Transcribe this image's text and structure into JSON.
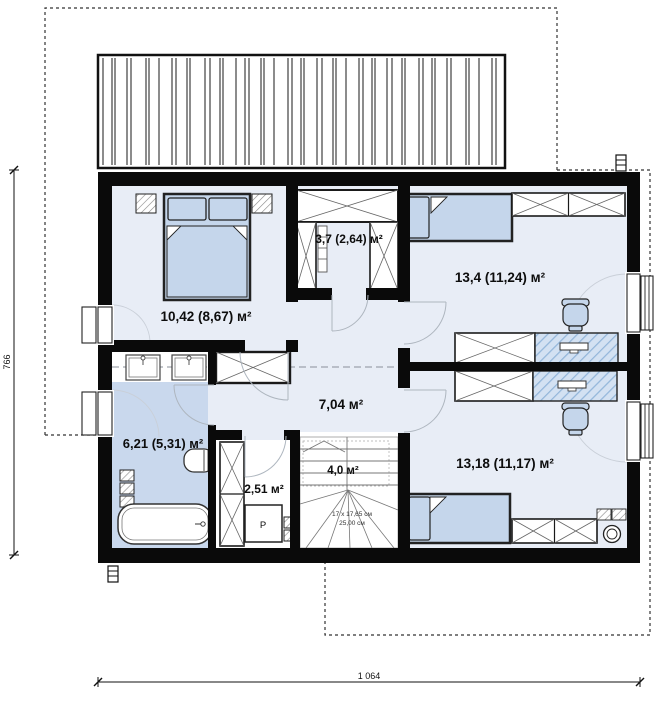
{
  "plan": {
    "rooms": {
      "bedroom1": {
        "area": "10,42 (8,67) м²"
      },
      "closet": {
        "area": "3,7 (2,64) м²"
      },
      "bedroom2": {
        "area": "13,4 (11,24) м²"
      },
      "hallway": {
        "area": "7,04 м²"
      },
      "bathroom": {
        "area": "6,21 (5,31) м²"
      },
      "utility": {
        "area": "2,51 м²"
      },
      "stairs": {
        "area": "4,0 м²",
        "note_line1": "17 x 17,65 см",
        "note_line2": "25,00 см"
      },
      "bedroom3": {
        "area": "13,18 (11,17) м²"
      }
    },
    "appliances": {
      "washer_label": "P"
    },
    "dimensions": {
      "height": "766",
      "width": "1 064"
    },
    "colors": {
      "wall": "#0a0a0a",
      "floor": "#e8edf6",
      "bath_floor": "#c9d8ed",
      "furniture": "#c5d6eb",
      "desk_hatch_base": "#d3e1f2",
      "desk_hatch_line": "#93b6da"
    }
  }
}
